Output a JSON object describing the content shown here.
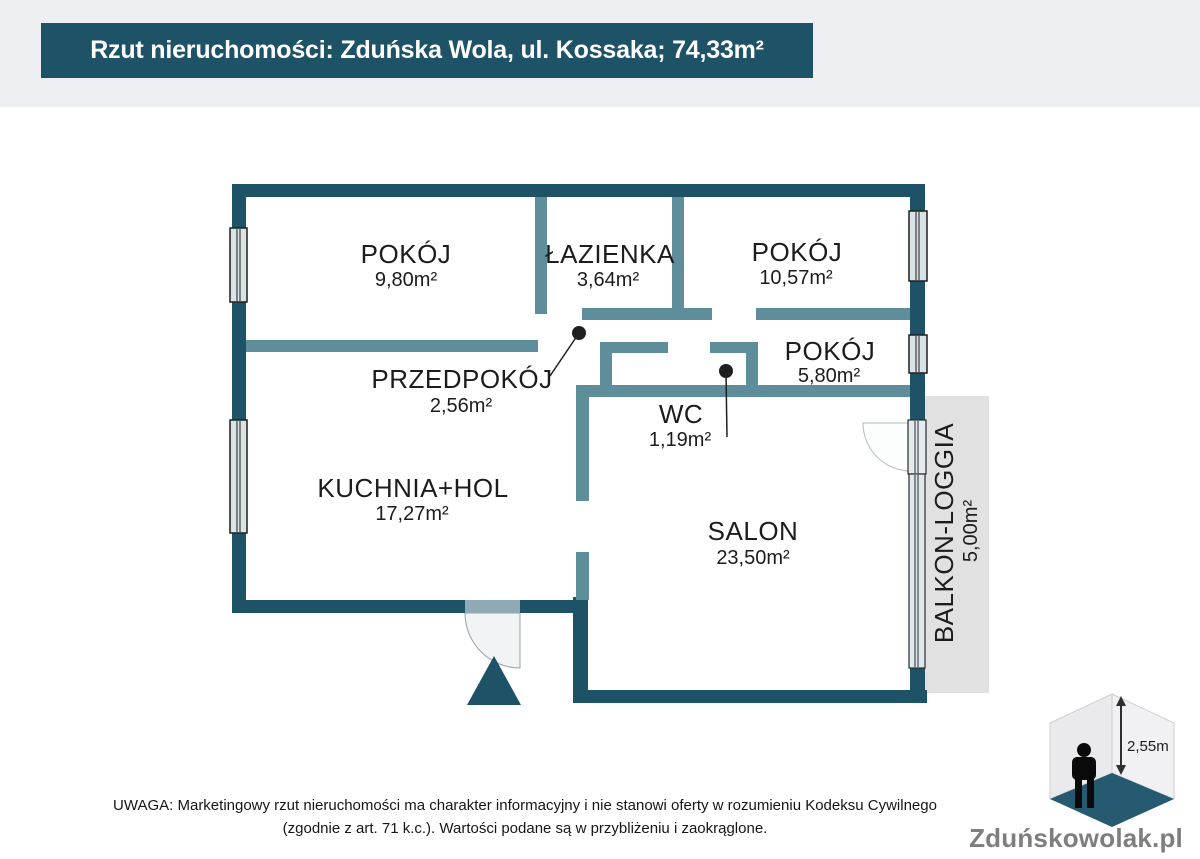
{
  "header": {
    "title": "Rzut nieruchomości: Zduńska Wola, ul. Kossaka; 74,33m²"
  },
  "rooms": [
    {
      "id": "pokoj-1",
      "name": "POKÓJ",
      "area": "9,80m²"
    },
    {
      "id": "lazienka",
      "name": "ŁAZIENKA",
      "area": "3,64m²"
    },
    {
      "id": "pokoj-2",
      "name": "POKÓJ",
      "area": "10,57m²"
    },
    {
      "id": "pokoj-3",
      "name": "POKÓJ",
      "area": "5,80m²"
    },
    {
      "id": "przedpokoj",
      "name": "PRZEDPOKÓJ",
      "area": "2,56m²"
    },
    {
      "id": "wc",
      "name": "WC",
      "area": "1,19m²"
    },
    {
      "id": "kuchnia",
      "name": "KUCHNIA+HOL",
      "area": "17,27m²"
    },
    {
      "id": "salon",
      "name": "SALON",
      "area": "23,50m²"
    },
    {
      "id": "balkon",
      "name": "BALKON-LOGGIA",
      "area": "5,00m²"
    }
  ],
  "logo": {
    "brand": "Zduńskowolak.pl",
    "ceiling_height": "2,55m"
  },
  "footer": {
    "line1": "UWAGA: Marketingowy rzut nieruchomości ma charakter informacyjny i nie stanowi oferty w rozumieniu Kodeksu Cywilnego",
    "line2": "(zgodnie z art. 71 k.c.). Wartości podane są w przybliżeniu i zaokrąglone."
  },
  "colors": {
    "wall_exterior": "#1e5266",
    "wall_interior": "#5e8e9a",
    "balcony_fill": "#e1e1e1",
    "background_top_band": "#edeff3",
    "logo_floor": "#255a70"
  }
}
